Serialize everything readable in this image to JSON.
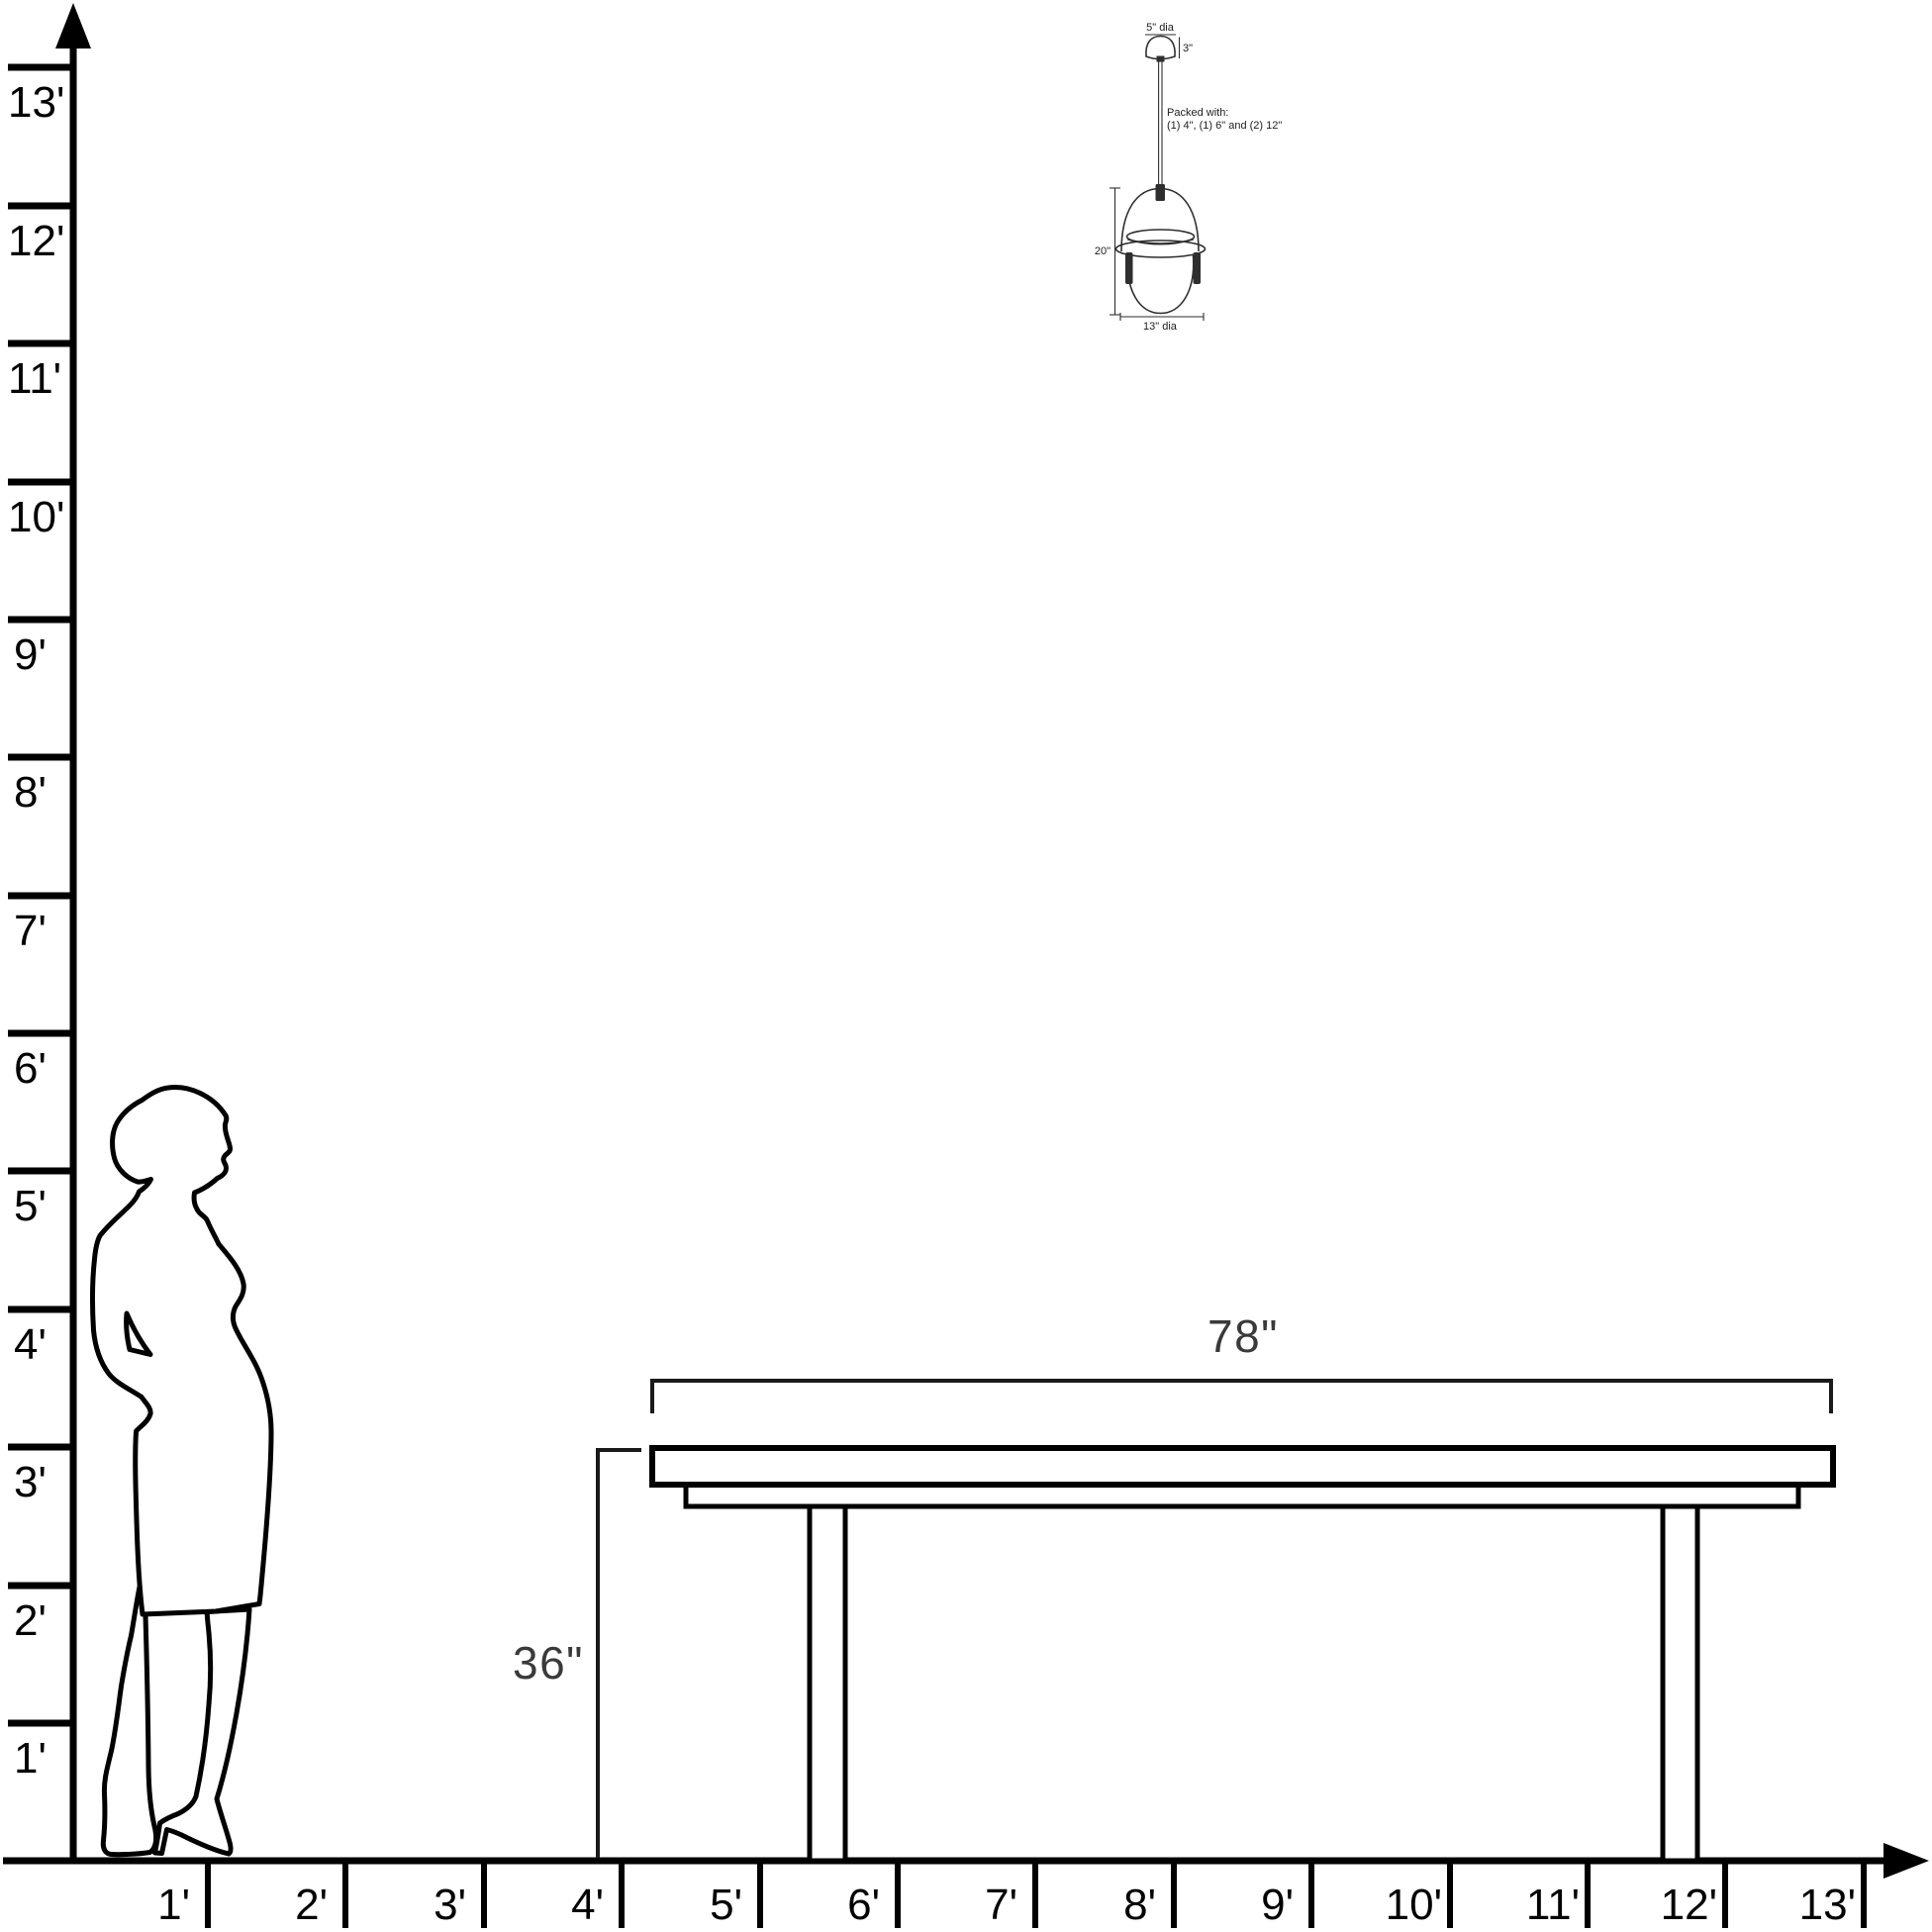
{
  "diagram_title": "furniture-scale-diagram",
  "vertical_axis": {
    "labels": [
      "1'",
      "2'",
      "3'",
      "4'",
      "5'",
      "6'",
      "7'",
      "8'",
      "9'",
      "10'",
      "11'",
      "12'",
      "13'"
    ]
  },
  "horizontal_axis": {
    "labels": [
      "1'",
      "2'",
      "3'",
      "4'",
      "5'",
      "6'",
      "7'",
      "8'",
      "9'",
      "10'",
      "11'",
      "12'",
      "13'"
    ]
  },
  "table": {
    "width_label": "78\"",
    "height_label": "36\""
  },
  "pendant": {
    "canopy_diameter_label": "5\" dia",
    "canopy_height_label": "3\"",
    "packed_with_line1": "Packed with:",
    "packed_with_line2": "(1) 4\", (1) 6\" and (2) 12\"",
    "body_height_label": "20\"",
    "body_diameter_label": "13\" dia"
  },
  "colors": {
    "axis": "#000000",
    "dimension": "#3a3a3a",
    "pendant_line": "#2e2e2e",
    "background": "#ffffff"
  }
}
